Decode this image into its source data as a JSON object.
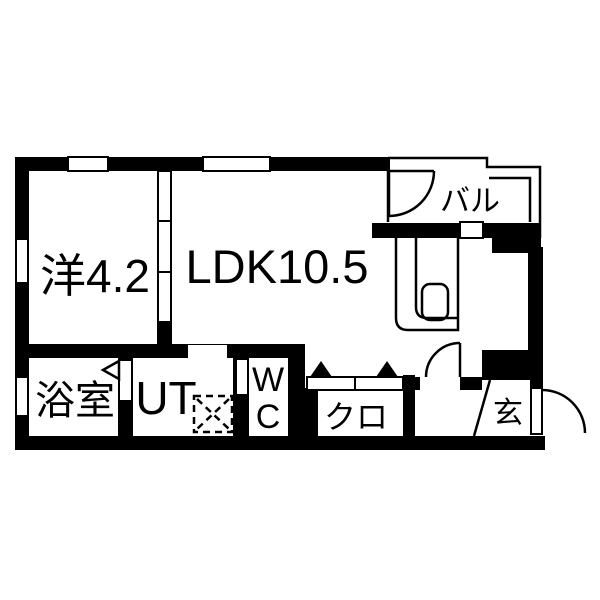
{
  "floorplan": {
    "title": "apartment-floorplan",
    "colors": {
      "wall": "#000000",
      "floor": "#ffffff",
      "line": "#000000"
    },
    "rooms": {
      "western": {
        "label": "洋4.2"
      },
      "ldk": {
        "label": "LDK10.5"
      },
      "balcony": {
        "label": "バル"
      },
      "bathroom": {
        "label": "浴室"
      },
      "utility": {
        "label": "UT"
      },
      "toilet": {
        "line1": "W",
        "line2": "C"
      },
      "closet": {
        "label": "クロ"
      },
      "entrance": {
        "label": "玄"
      }
    },
    "fixtures": {
      "kitchen_counter": "kitchen-counter-with-sink",
      "washing_machine": "washing-machine-pan-dashed",
      "sliding_door": "three-panel-sliding-door",
      "closet_doors": "folding-door-triangles",
      "door_swings": [
        "balcony-door",
        "hall-door",
        "entrance-door"
      ],
      "windows": 5
    }
  }
}
